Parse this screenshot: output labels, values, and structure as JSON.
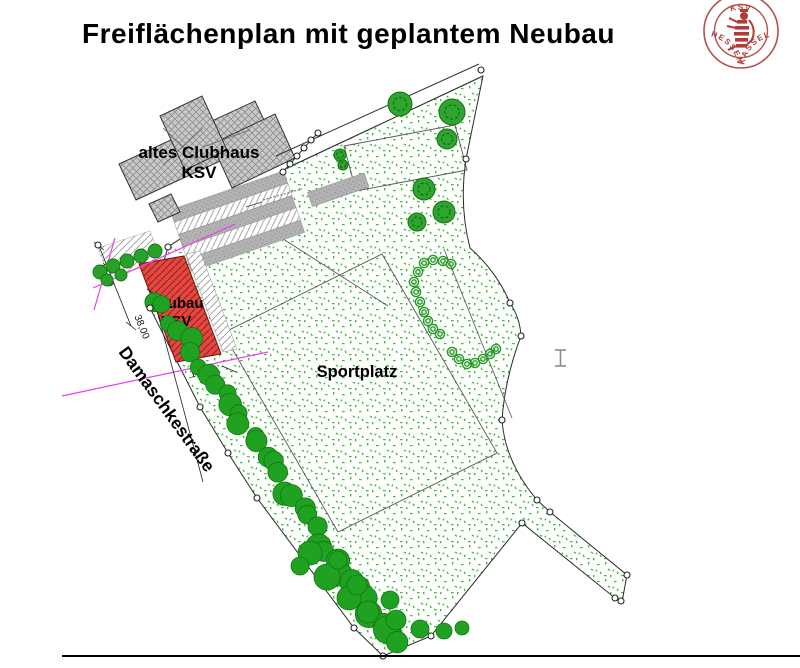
{
  "title": "Freiflächenplan mit geplantem Neubau",
  "logo": {
    "top": "KSV",
    "left": "HESSEN",
    "right": "KASSEL"
  },
  "plan": {
    "labels": {
      "old_clubhouse_1": "altes Clubhaus",
      "old_clubhouse_2": "KSV",
      "new_building_1": "Neubau",
      "new_building_2": "KSV",
      "sports_field": "Sportplatz",
      "street": "Damaschkestraße"
    },
    "dimensions": {
      "street_width": "16,00",
      "frontage": "38,00",
      "offset": "10,49"
    },
    "colors": {
      "new_building": "#e14842",
      "vegetation_green": "#2aa12a",
      "pavement_gray": "#b2b2b2",
      "survey_magenta": "#ee3cee",
      "logo_red": "#b23a36"
    }
  }
}
